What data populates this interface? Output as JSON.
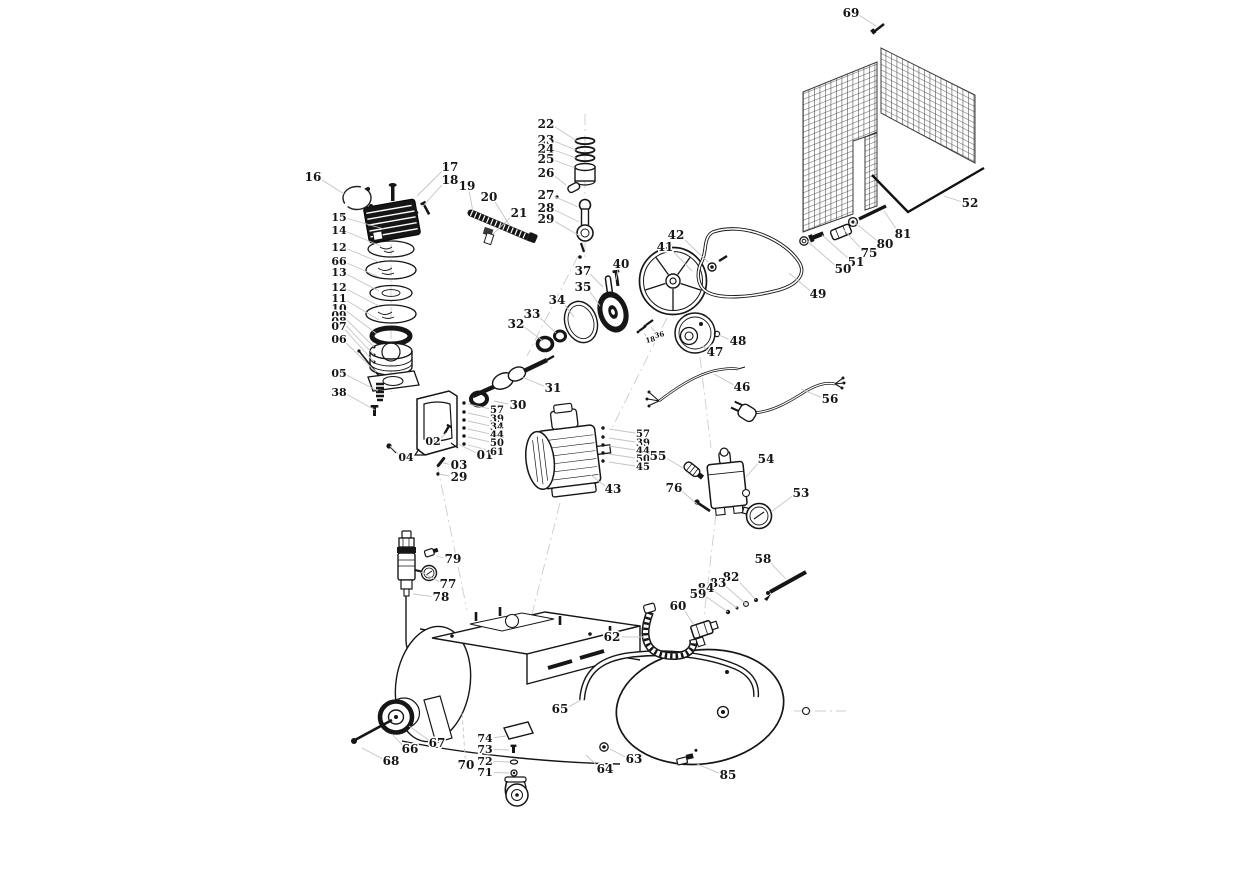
{
  "diagram": {
    "kind": "exploded-parts-diagram",
    "background": "#ffffff",
    "ink_color": "#161616",
    "leader_color": "#c4c4c4",
    "mesh_color": "#4a4a4a",
    "label_font_size": 12
  },
  "callouts": [
    {
      "id": "69",
      "lx": 851,
      "ly": 17,
      "px": 876,
      "py": 26
    },
    {
      "id": "52",
      "lx": 970,
      "ly": 207,
      "px": 944,
      "py": 196
    },
    {
      "id": "81",
      "lx": 903,
      "ly": 238,
      "px": 884,
      "py": 211
    },
    {
      "id": "80",
      "lx": 885,
      "ly": 248,
      "px": 854,
      "py": 222
    },
    {
      "id": "75",
      "lx": 869,
      "ly": 257,
      "px": 844,
      "py": 230
    },
    {
      "id": "51",
      "lx": 856,
      "ly": 266,
      "px": 822,
      "py": 235
    },
    {
      "id": "50",
      "lx": 843,
      "ly": 273,
      "px": 806,
      "py": 240
    },
    {
      "id": "42",
      "lx": 676,
      "ly": 239,
      "px": 708,
      "py": 262
    },
    {
      "id": "41",
      "lx": 665,
      "ly": 251,
      "px": 692,
      "py": 271
    },
    {
      "id": "49",
      "lx": 818,
      "ly": 298,
      "px": 789,
      "py": 273
    },
    {
      "id": "48",
      "lx": 738,
      "ly": 345,
      "px": 719,
      "py": 335
    },
    {
      "id": "47",
      "lx": 715,
      "ly": 356,
      "px": 703,
      "py": 346
    },
    {
      "id": "40",
      "lx": 621,
      "ly": 268,
      "px": 616,
      "py": 280
    },
    {
      "id": "37",
      "lx": 583,
      "ly": 275,
      "px": 603,
      "py": 287
    },
    {
      "id": "35",
      "lx": 583,
      "ly": 291,
      "px": 600,
      "py": 306
    },
    {
      "id": "34",
      "lx": 557,
      "ly": 304,
      "px": 574,
      "py": 317
    },
    {
      "id": "33",
      "lx": 532,
      "ly": 318,
      "px": 556,
      "py": 333
    },
    {
      "id": "32",
      "lx": 516,
      "ly": 328,
      "px": 543,
      "py": 341
    },
    {
      "id": "31",
      "lx": 553,
      "ly": 392,
      "px": 522,
      "py": 377
    },
    {
      "id": "30",
      "lx": 518,
      "ly": 409,
      "px": 494,
      "py": 401
    },
    {
      "id": "18",
      "lx": 651,
      "ly": 342,
      "px": 644,
      "py": 333,
      "size": 7,
      "rot": -14
    },
    {
      "id": "36",
      "lx": 660,
      "ly": 337,
      "px": 651,
      "py": 327,
      "size": 7,
      "rot": -14
    },
    {
      "id": "22",
      "lx": 546,
      "ly": 128,
      "px": 577,
      "py": 141
    },
    {
      "id": "23",
      "lx": 546,
      "ly": 144,
      "px": 576,
      "py": 150
    },
    {
      "id": "24",
      "lx": 546,
      "ly": 153,
      "px": 576,
      "py": 158
    },
    {
      "id": "25",
      "lx": 546,
      "ly": 163,
      "px": 575,
      "py": 168
    },
    {
      "id": "26",
      "lx": 546,
      "ly": 177,
      "px": 566,
      "py": 185
    },
    {
      "id": "27",
      "lx": 546,
      "ly": 199,
      "px": 578,
      "py": 207
    },
    {
      "id": "28",
      "lx": 546,
      "ly": 212,
      "px": 579,
      "py": 222
    },
    {
      "id": "29",
      "lx": 546,
      "ly": 223,
      "px": 580,
      "py": 236
    },
    {
      "id": "17",
      "lx": 450,
      "ly": 171,
      "px": 417,
      "py": 196
    },
    {
      "id": "18",
      "lx": 450,
      "ly": 184,
      "px": 423,
      "py": 206
    },
    {
      "id": "19",
      "lx": 467,
      "ly": 190,
      "px": 473,
      "py": 212
    },
    {
      "id": "20",
      "lx": 489,
      "ly": 201,
      "px": 510,
      "py": 226
    },
    {
      "id": "21",
      "lx": 519,
      "ly": 217,
      "px": 493,
      "py": 234
    },
    {
      "id": "16",
      "lx": 313,
      "ly": 181,
      "px": 344,
      "py": 194
    },
    {
      "id": "15",
      "lx": 339,
      "ly": 221,
      "px": 384,
      "py": 229,
      "size": 11
    },
    {
      "id": "14",
      "lx": 339,
      "ly": 234,
      "px": 381,
      "py": 246,
      "size": 11
    },
    {
      "id": "12",
      "lx": 339,
      "ly": 251,
      "px": 379,
      "py": 262,
      "size": 11
    },
    {
      "id": "66",
      "lx": 339,
      "ly": 265,
      "px": 379,
      "py": 277,
      "size": 11
    },
    {
      "id": "13",
      "lx": 339,
      "ly": 276,
      "px": 379,
      "py": 291,
      "size": 11
    },
    {
      "id": "12",
      "lx": 339,
      "ly": 291,
      "px": 379,
      "py": 306,
      "size": 11
    },
    {
      "id": "11",
      "lx": 339,
      "ly": 302,
      "px": 379,
      "py": 320,
      "size": 11
    },
    {
      "id": "10",
      "lx": 339,
      "ly": 312,
      "px": 377,
      "py": 334,
      "size": 11
    },
    {
      "id": "09",
      "lx": 339,
      "ly": 319,
      "px": 374,
      "py": 347,
      "size": 11
    },
    {
      "id": "08",
      "lx": 339,
      "ly": 325,
      "px": 374,
      "py": 355,
      "size": 11
    },
    {
      "id": "07",
      "lx": 339,
      "ly": 330,
      "px": 374,
      "py": 362,
      "size": 11
    },
    {
      "id": "06",
      "lx": 339,
      "ly": 343,
      "px": 376,
      "py": 372,
      "size": 11
    },
    {
      "id": "05",
      "lx": 339,
      "ly": 377,
      "px": 378,
      "py": 391,
      "size": 11
    },
    {
      "id": "38",
      "lx": 339,
      "ly": 396,
      "px": 375,
      "py": 410,
      "size": 11
    },
    {
      "id": "02",
      "lx": 433,
      "ly": 445,
      "px": 446,
      "py": 433,
      "size": 11
    },
    {
      "id": "04",
      "lx": 406,
      "ly": 461,
      "px": 390,
      "py": 446,
      "size": 11
    },
    {
      "id": "03",
      "lx": 459,
      "ly": 469,
      "px": 443,
      "py": 463
    },
    {
      "id": "29",
      "lx": 459,
      "ly": 481,
      "px": 439,
      "py": 474
    },
    {
      "id": "01",
      "lx": 485,
      "ly": 459,
      "px": 458,
      "py": 444
    },
    {
      "id": "57",
      "lx": 497,
      "ly": 413,
      "px": 468,
      "py": 404,
      "size": 10
    },
    {
      "id": "39",
      "lx": 497,
      "ly": 422,
      "px": 468,
      "py": 413,
      "size": 10
    },
    {
      "id": "34",
      "lx": 497,
      "ly": 430,
      "px": 468,
      "py": 421,
      "size": 10
    },
    {
      "id": "44",
      "lx": 497,
      "ly": 438,
      "px": 468,
      "py": 429,
      "size": 10
    },
    {
      "id": "50",
      "lx": 497,
      "ly": 446,
      "px": 468,
      "py": 437,
      "size": 10
    },
    {
      "id": "61",
      "lx": 497,
      "ly": 455,
      "px": 468,
      "py": 445,
      "size": 10
    },
    {
      "id": "43",
      "lx": 613,
      "ly": 493,
      "px": 591,
      "py": 475
    },
    {
      "id": "57",
      "lx": 643,
      "ly": 437,
      "px": 609,
      "py": 429,
      "size": 10
    },
    {
      "id": "39",
      "lx": 643,
      "ly": 446,
      "px": 609,
      "py": 438,
      "size": 10
    },
    {
      "id": "44",
      "lx": 643,
      "ly": 454,
      "px": 609,
      "py": 446,
      "size": 10
    },
    {
      "id": "50",
      "lx": 643,
      "ly": 462,
      "px": 609,
      "py": 454,
      "size": 10
    },
    {
      "id": "45",
      "lx": 643,
      "ly": 470,
      "px": 609,
      "py": 462,
      "size": 10
    },
    {
      "id": "55",
      "lx": 658,
      "ly": 460,
      "px": 683,
      "py": 468
    },
    {
      "id": "76",
      "lx": 674,
      "ly": 492,
      "px": 697,
      "py": 504
    },
    {
      "id": "54",
      "lx": 766,
      "ly": 463,
      "px": 746,
      "py": 477
    },
    {
      "id": "53",
      "lx": 801,
      "ly": 497,
      "px": 771,
      "py": 512
    },
    {
      "id": "46",
      "lx": 742,
      "ly": 391,
      "px": 714,
      "py": 374
    },
    {
      "id": "56",
      "lx": 830,
      "ly": 403,
      "px": 801,
      "py": 389
    },
    {
      "id": "79",
      "lx": 453,
      "ly": 563,
      "px": 437,
      "py": 556
    },
    {
      "id": "77",
      "lx": 448,
      "ly": 588,
      "px": 421,
      "py": 572
    },
    {
      "id": "78",
      "lx": 441,
      "ly": 601,
      "px": 413,
      "py": 594
    },
    {
      "id": "58",
      "lx": 763,
      "ly": 563,
      "px": 786,
      "py": 579
    },
    {
      "id": "82",
      "lx": 731,
      "ly": 581,
      "px": 756,
      "py": 600
    },
    {
      "id": "83",
      "lx": 718,
      "ly": 587,
      "px": 746,
      "py": 604
    },
    {
      "id": "84",
      "lx": 706,
      "ly": 592,
      "px": 737,
      "py": 608
    },
    {
      "id": "59",
      "lx": 698,
      "ly": 598,
      "px": 728,
      "py": 612
    },
    {
      "id": "60",
      "lx": 678,
      "ly": 610,
      "px": 694,
      "py": 625
    },
    {
      "id": "62",
      "lx": 612,
      "ly": 641,
      "px": 644,
      "py": 637
    },
    {
      "id": "65",
      "lx": 560,
      "ly": 713,
      "px": 581,
      "py": 700
    },
    {
      "id": "67",
      "lx": 437,
      "ly": 747,
      "px": 409,
      "py": 726
    },
    {
      "id": "66",
      "lx": 410,
      "ly": 753,
      "px": 392,
      "py": 734
    },
    {
      "id": "68",
      "lx": 391,
      "ly": 765,
      "px": 362,
      "py": 748
    },
    {
      "id": "74",
      "lx": 485,
      "ly": 742,
      "px": 506,
      "py": 736,
      "size": 11
    },
    {
      "id": "73",
      "lx": 485,
      "ly": 753,
      "px": 509,
      "py": 750,
      "size": 11
    },
    {
      "id": "72",
      "lx": 485,
      "ly": 765,
      "px": 509,
      "py": 762,
      "size": 11
    },
    {
      "id": "71",
      "lx": 485,
      "ly": 776,
      "px": 509,
      "py": 773,
      "size": 11
    },
    {
      "id": "70",
      "lx": 466,
      "ly": 769,
      "px": 462,
      "py": 712,
      "dash": true
    },
    {
      "id": "64",
      "lx": 605,
      "ly": 773,
      "px": 586,
      "py": 755
    },
    {
      "id": "63",
      "lx": 634,
      "ly": 763,
      "px": 610,
      "py": 749
    },
    {
      "id": "85",
      "lx": 728,
      "ly": 779,
      "px": 697,
      "py": 764
    }
  ]
}
